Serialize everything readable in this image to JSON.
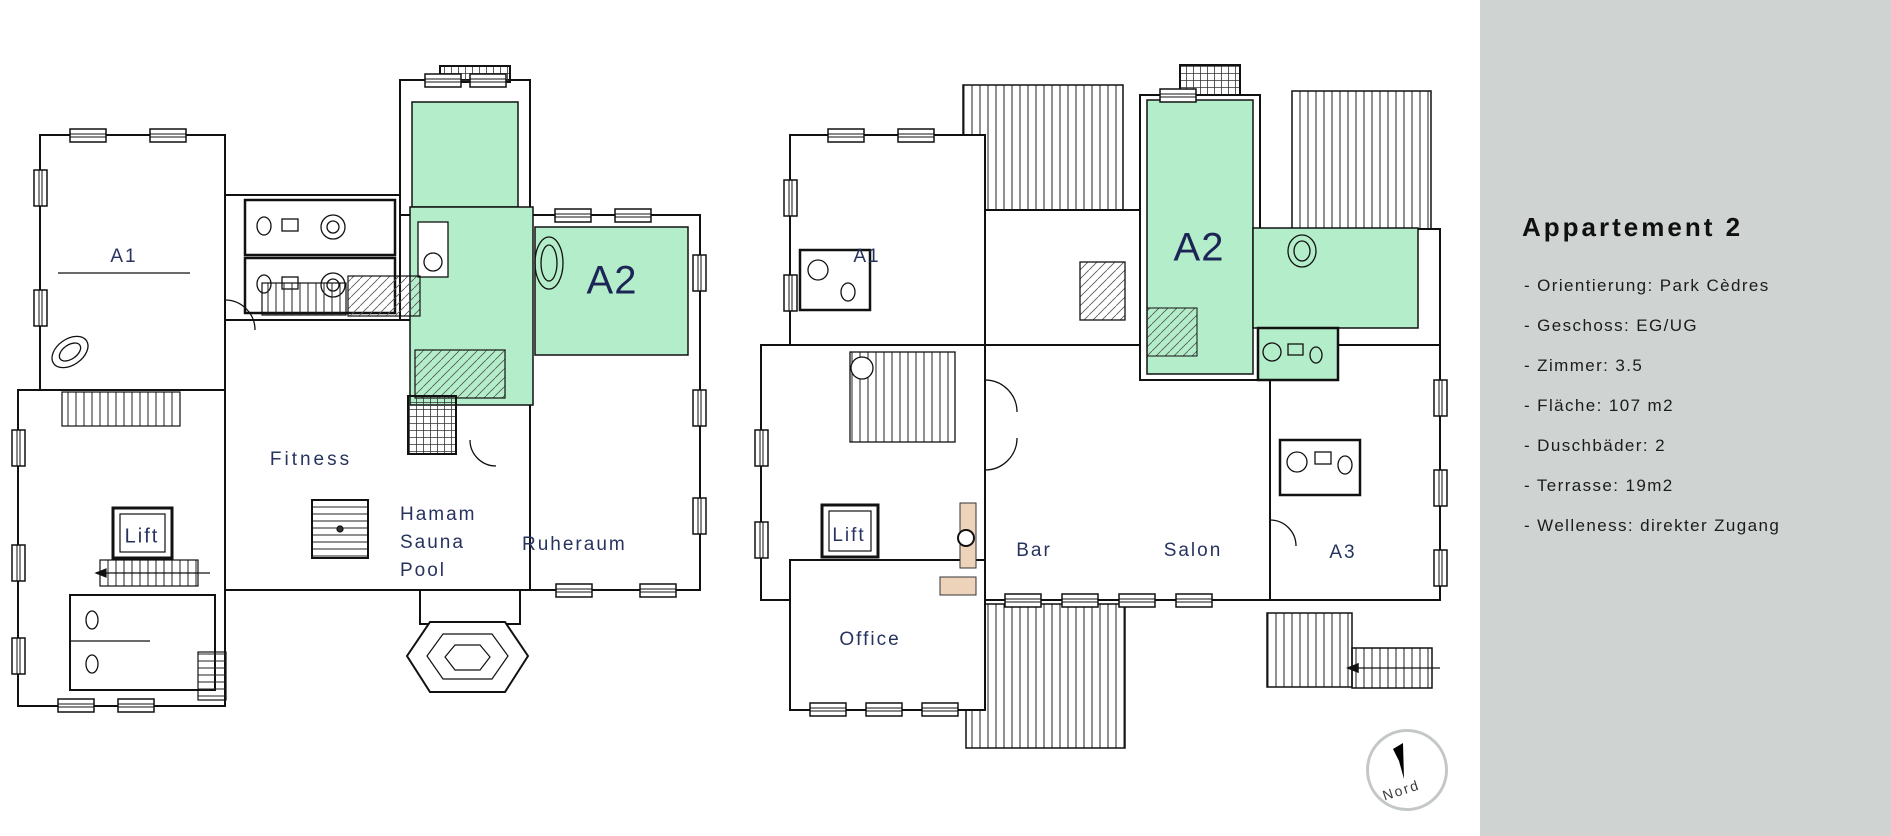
{
  "sidebar": {
    "title": "Appartement 2",
    "details": [
      "- Orientierung: Park Cèdres",
      "- Geschoss: EG/UG",
      "- Zimmer: 3.5",
      "- Fläche: 107 m2",
      "- Duschbäder: 2",
      "- Terrasse: 19m2",
      "- Welleness: direkter Zugang"
    ]
  },
  "plans": {
    "left": {
      "labels": {
        "a1": "A1",
        "a2": "A2",
        "fitness": "Fitness",
        "lift": "Lift",
        "hamam": [
          "Hamam",
          "Sauna",
          "Pool"
        ],
        "ruheraum": "Ruheraum"
      }
    },
    "right": {
      "labels": {
        "a1": "A1",
        "a2": "A2",
        "lift": "Lift",
        "bar": "Bar",
        "salon": "Salon",
        "a3": "A3",
        "office": "Office"
      }
    }
  },
  "compass": {
    "label": "Nord"
  },
  "colors": {
    "highlight_green": "#b4edc9",
    "fireplace_peach": "#eed3bb",
    "sidebar_bg": "#cfd3d1",
    "label_navy": "#27335f",
    "label_navy_big": "#1d2556"
  }
}
